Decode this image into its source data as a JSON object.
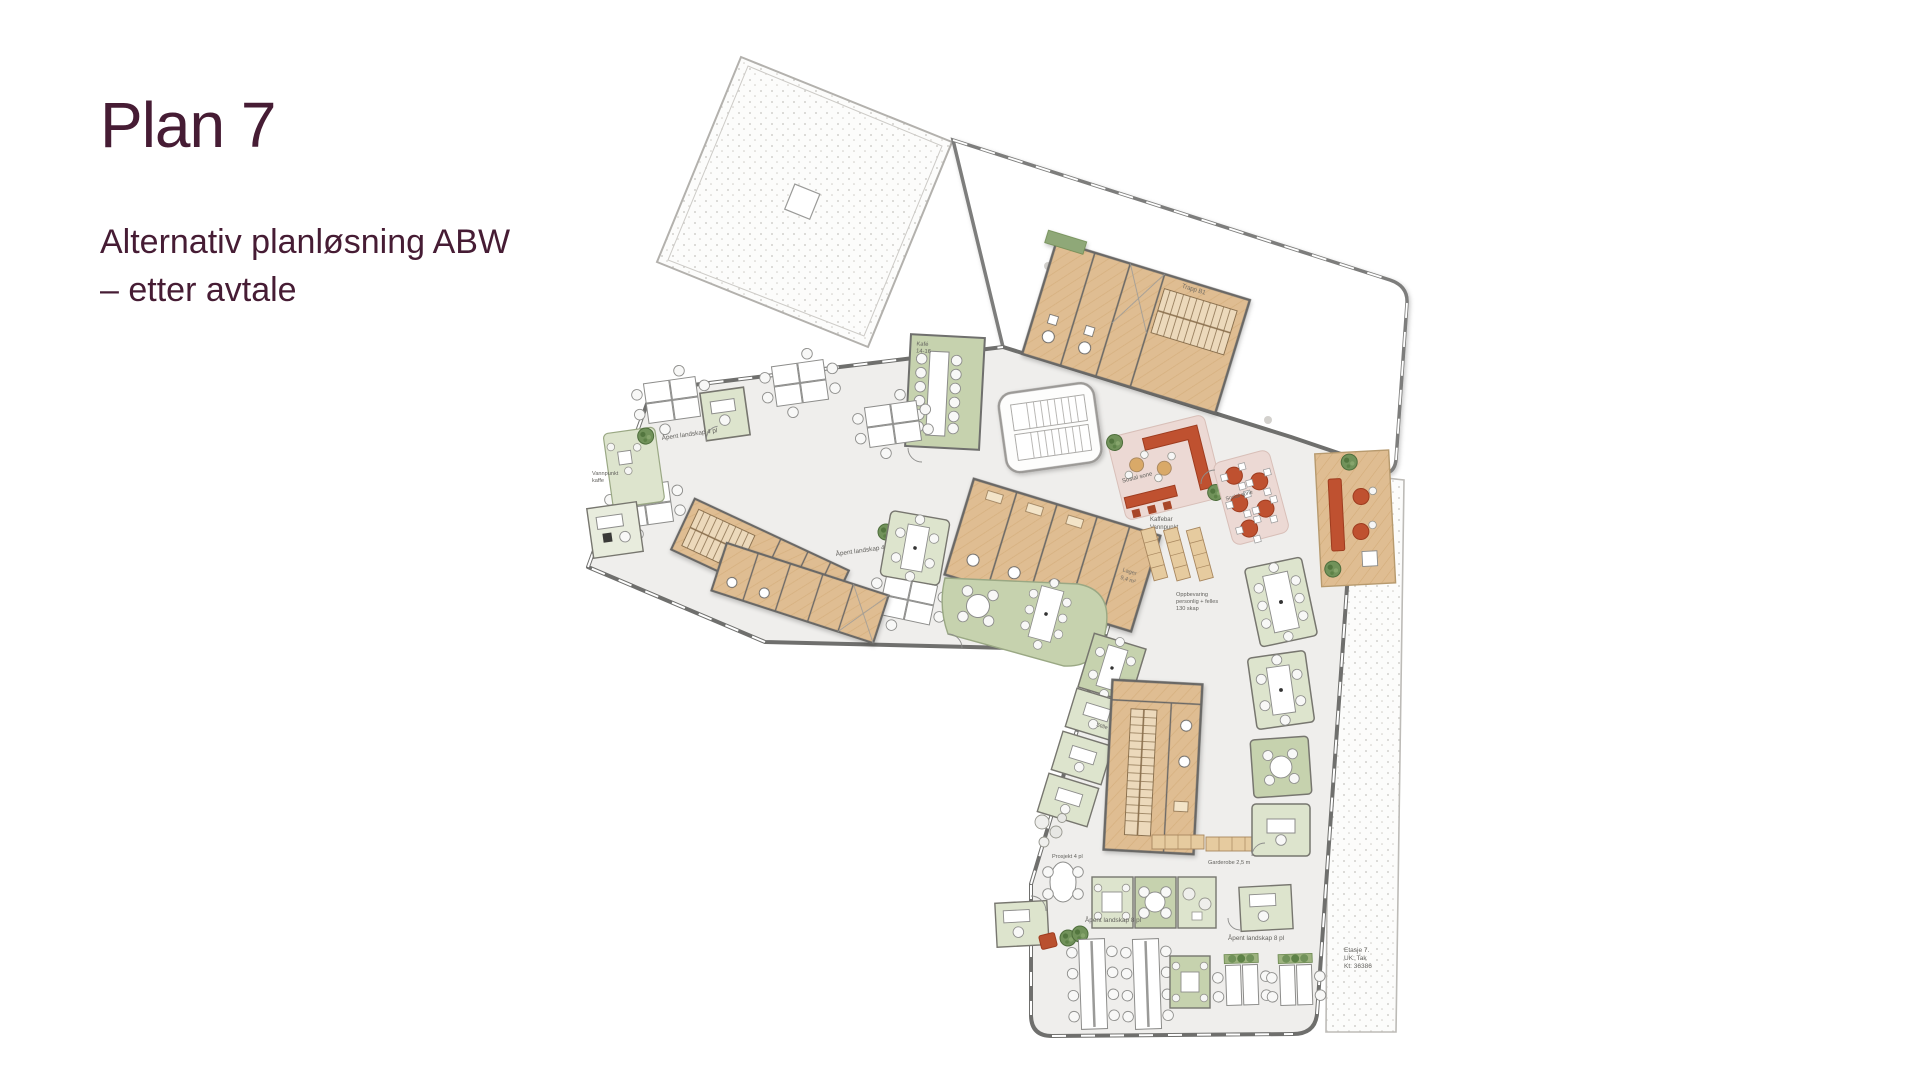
{
  "slide": {
    "title": "Plan 7",
    "subtitle_line1": "Alternativ planløsning ABW",
    "subtitle_line2": "– etter avtale"
  },
  "colors": {
    "title_text": "#461c34",
    "floor": "#efeeec",
    "wall": "#6f6f6d",
    "wood_core": "#dfbd92",
    "green_zone": "#c6d2ae",
    "green_room": "#dde4cd",
    "pink_zone": "#ecd9d4",
    "red_furniture": "#bf5130",
    "stipple_dot": "#c6c4c0",
    "plant_green": "#6d8f55"
  },
  "floorplan": {
    "labels": {
      "open_landscape_4": "Åpent landskap 4 pl",
      "open_landscape_8": "Åpent landskap 8 pl",
      "social_zone": "Sosial sone",
      "coffee_bar": "Kaffebar",
      "water_point": "Vannpunkt",
      "cafe_name": "Kafé",
      "cafe_seats": "14-16",
      "storage_room": "Lager",
      "storage_area": "9,4 m²",
      "stair_name": "Trapp B1",
      "lockers_1": "Oppbevaring",
      "lockers_2": "personlig + felles",
      "lockers_3": "130 skap",
      "project": "Prosjekt 4 pl",
      "wardrobe": "Garderobe 2,5 m",
      "quiet_room": "Stille rom",
      "water_coffee_1": "Vannpunkt",
      "water_coffee_2": "kaffe",
      "floor_note_1": "Etasje 7.",
      "floor_note_2": "UK: Tak",
      "floor_note_3": "Kt: 36386"
    }
  }
}
